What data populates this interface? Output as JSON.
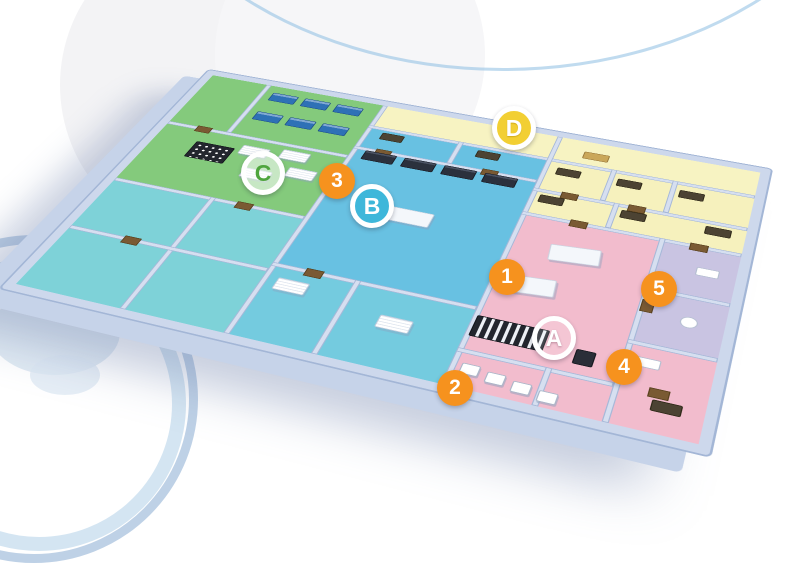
{
  "scene": {
    "background": "#ffffff",
    "type": "3d-isometric-floorplan"
  },
  "palette": {
    "wall": "#cdd8ec",
    "wall_edge": "#a3b6d6",
    "zone_green": "#84ca7c",
    "zone_cyan": "#68c1e2",
    "zone_teal": "#7ed2d8",
    "zone_yellow": "#f6f1bd",
    "zone_pink": "#f2bccd",
    "zone_lavender": "#c9c4e2",
    "marker_orange": "#f6921e",
    "marker_b_fill": "#3eb7da",
    "marker_c_text": "#4fa53d",
    "marker_d_fill": "#f2cf33"
  },
  "markers": {
    "zone_labels": [
      {
        "id": "A",
        "label": "A",
        "zone_color": "#f2bccd",
        "fill": "rgba(255,255,255,0.15)",
        "text_color": "#ffffff"
      },
      {
        "id": "B",
        "label": "B",
        "zone_color": "#68c1e2",
        "fill": "#3eb7da",
        "text_color": "#ffffff"
      },
      {
        "id": "C",
        "label": "C",
        "zone_color": "#84ca7c",
        "fill": "rgba(255,255,255,0.55)",
        "text_color": "#4fa53d"
      },
      {
        "id": "D",
        "label": "D",
        "zone_color": "#f6f1bd",
        "fill": "#f2cf33",
        "text_color": "#ffffff"
      }
    ],
    "point_labels": [
      {
        "id": "1",
        "label": "1",
        "fill": "#f6921e",
        "text_color": "#ffffff"
      },
      {
        "id": "2",
        "label": "2",
        "fill": "#f6921e",
        "text_color": "#ffffff"
      },
      {
        "id": "3",
        "label": "3",
        "fill": "#f6921e",
        "text_color": "#ffffff"
      },
      {
        "id": "4",
        "label": "4",
        "fill": "#f6921e",
        "text_color": "#ffffff"
      },
      {
        "id": "5",
        "label": "5",
        "fill": "#f6921e",
        "text_color": "#ffffff"
      }
    ]
  }
}
